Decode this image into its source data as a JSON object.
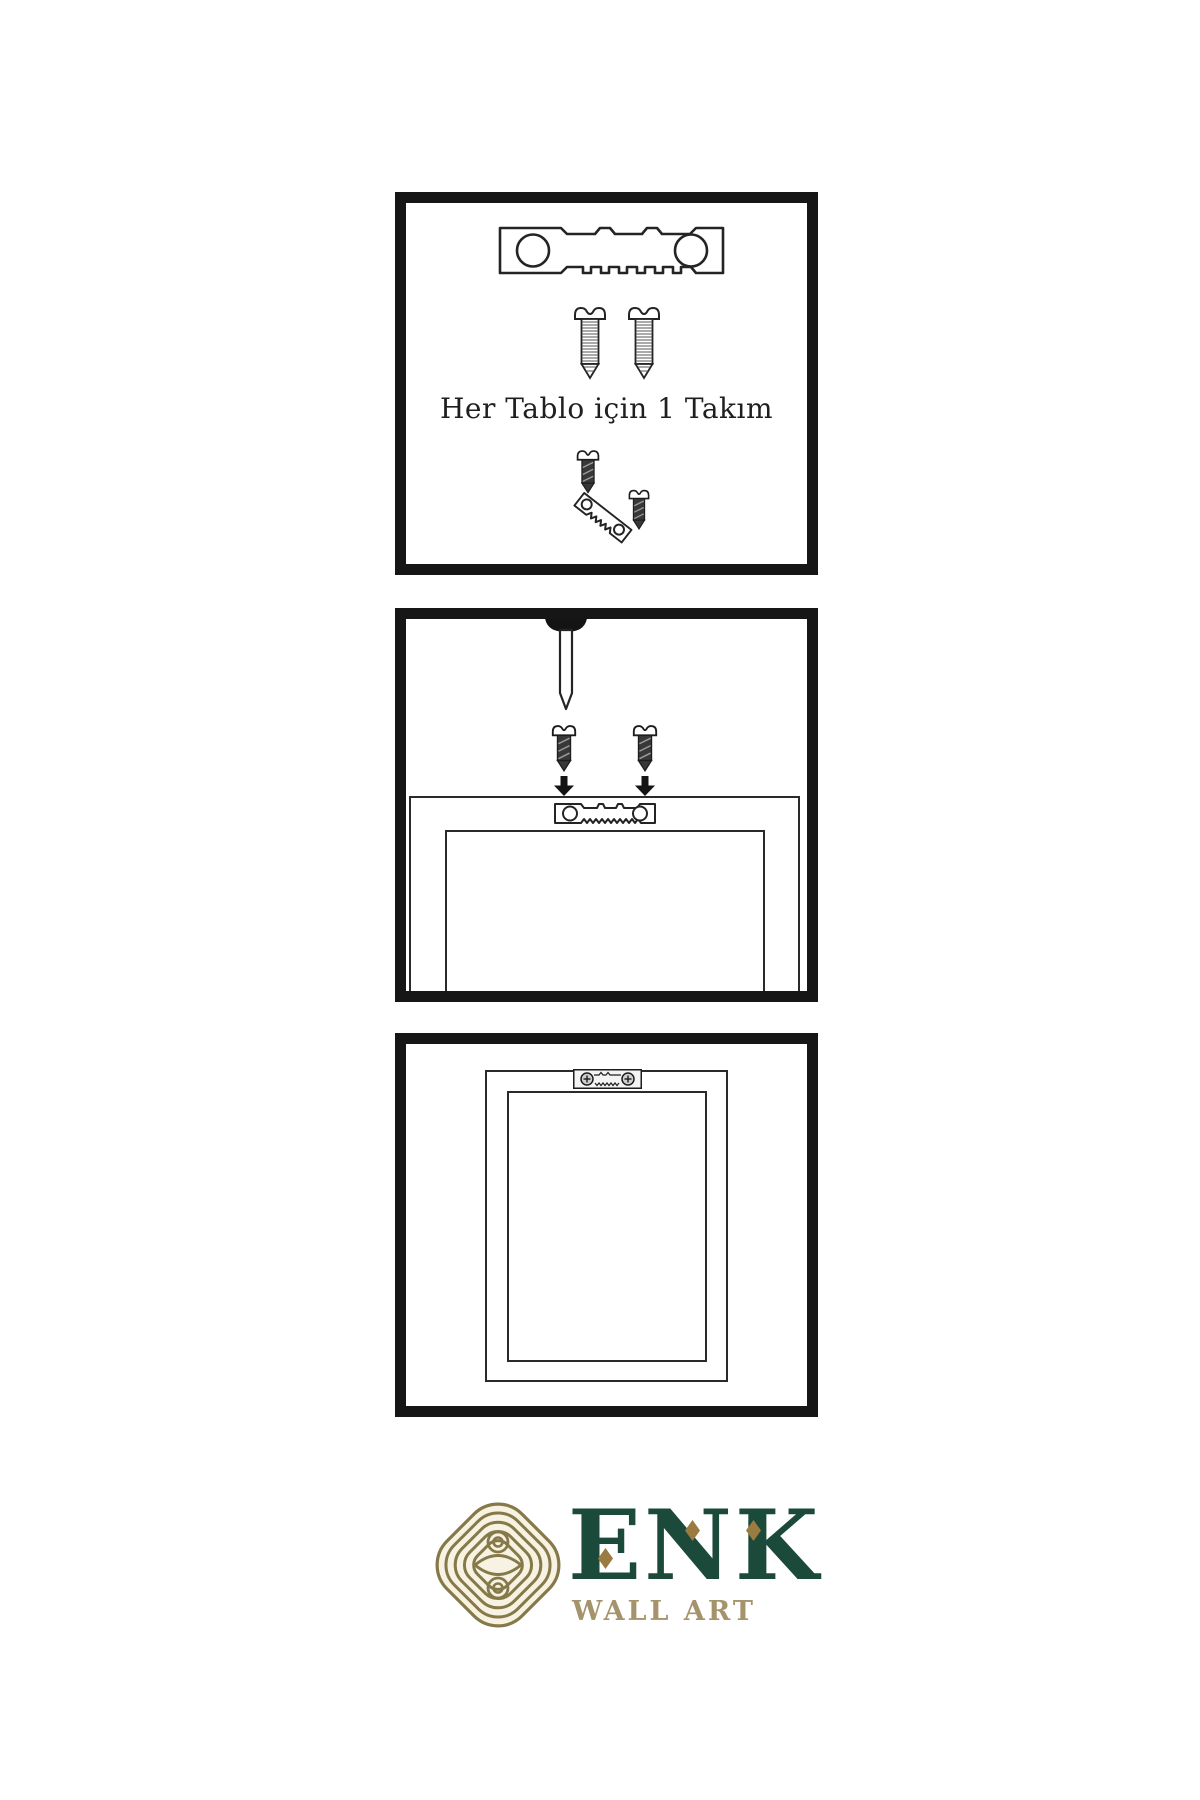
{
  "page": {
    "background": "#ffffff",
    "kind": "wall-art hanging instruction sheet"
  },
  "steps": {
    "kit": {
      "caption": "Her Tablo için 1 Takım",
      "pictograms": [
        "sawtooth-hanger",
        "screw",
        "screw",
        "screw-with-angled-hanger"
      ]
    },
    "mount": {
      "pictograms": [
        "nail-in-wall",
        "screw-with-down-arrow",
        "screw-with-down-arrow",
        "frame-back-with-sawtooth-hanger"
      ]
    },
    "hang": {
      "pictograms": [
        "hung-frame-with-mounted-hanger"
      ]
    }
  },
  "brand": {
    "name": "ENK",
    "tagline": "WALL ART"
  },
  "colors": {
    "panel_border": "#161616",
    "line_art": "#242424",
    "screw_body": "#383838",
    "brand_green": "#1b4a3b",
    "brand_gold": "#9a7b41",
    "brand_gold_muted": "#a5946b",
    "logo_icon_gold": "#867949",
    "logo_icon_fill": "#f7f2e2"
  }
}
